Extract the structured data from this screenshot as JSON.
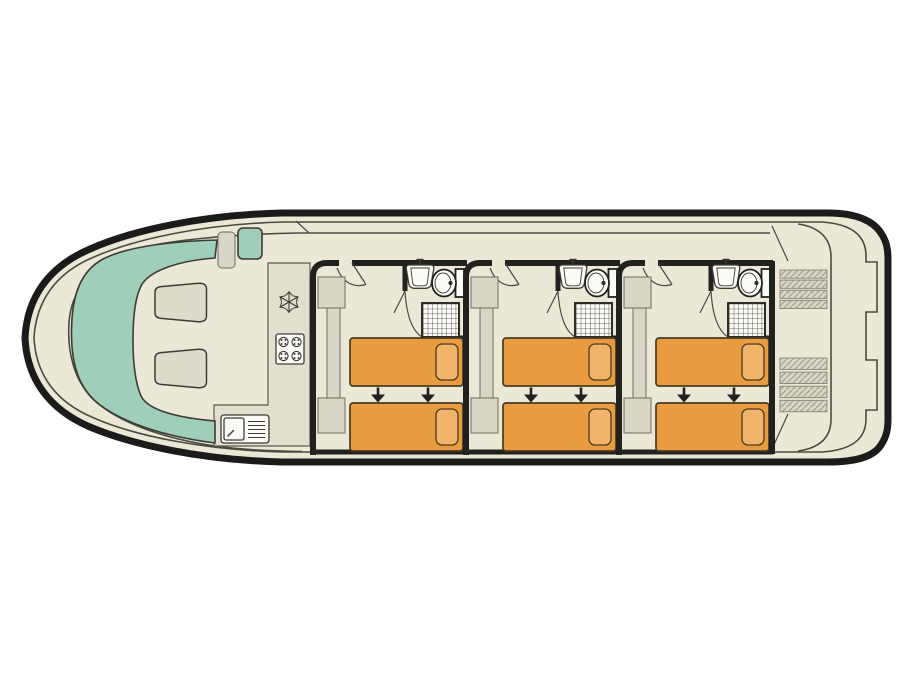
{
  "colors": {
    "background": "#ffffff",
    "hull": "#1b1b19",
    "wall": "#21211d",
    "deck": "#ece8d6",
    "line": "#4a4a40",
    "outline": "#3c3c34",
    "counter": "#e3dfcf",
    "furniture": "#d9d5c7",
    "sofa": "#9fceb9",
    "table": "#dfdbcc",
    "bed": "#e89b3f",
    "pillow": "#f2b469",
    "bed_outline": "#473a22",
    "fixture": "#fbfaf5"
  },
  "boat": {
    "orientation": "bow-left",
    "saloon": {
      "sofa": "u-shaped-bench",
      "seat_tables": 2,
      "helm_seats": 2
    },
    "galley": {
      "appliances": [
        "fridge-freezer",
        "hob-4-burner",
        "sink-with-drainer"
      ]
    },
    "cabins": {
      "count": 3,
      "offsets": [
        0,
        153,
        306
      ],
      "per_cabin": {
        "beds": 2,
        "pillows": 2,
        "slide_together_arrows": 2,
        "wardrobe": true,
        "ensuite": [
          "washbasin",
          "toilet",
          "shower"
        ]
      }
    },
    "stern": {
      "boarding_gates": 2,
      "stairways": [
        {
          "x": 780,
          "y": 270,
          "width": 47,
          "steps": 4,
          "step_height": 8.2,
          "gap": 1.9
        },
        {
          "x": 780,
          "y": 358,
          "width": 47,
          "steps": 4,
          "step_height": 11.5,
          "gap": 2.6
        }
      ]
    }
  }
}
